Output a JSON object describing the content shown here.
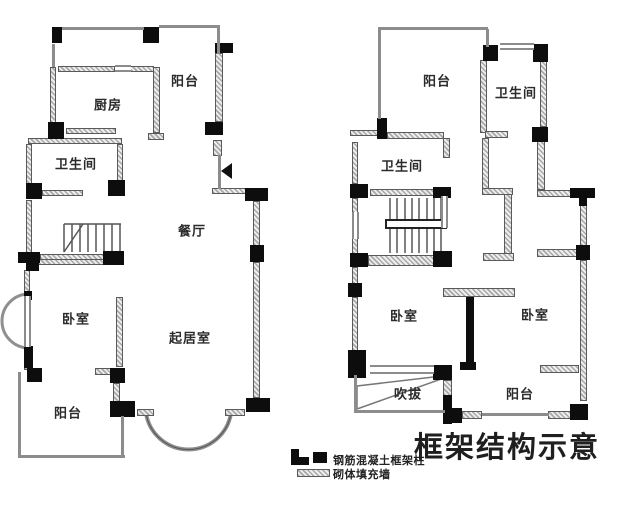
{
  "title": "框架结构示意",
  "legend": {
    "items": [
      {
        "symbol": "concrete-column",
        "label": "钢筋混凝土框架柱"
      },
      {
        "symbol": "masonry-infill-wall",
        "label": "砌体填充墙"
      }
    ]
  },
  "floor_left": {
    "rooms": {
      "balcony_top": "阳台",
      "kitchen": "厨房",
      "bathroom": "卫生间",
      "dining": "餐厅",
      "bedroom": "卧室",
      "living": "起居室",
      "balcony_bottom": "阳台"
    }
  },
  "floor_right": {
    "rooms": {
      "balcony_top": "阳台",
      "bathroom_top": "卫生间",
      "bathroom_mid": "卫生间",
      "bedroom_left": "卧室",
      "bedroom_right": "卧室",
      "void": "吹拔",
      "balcony_bottom": "阳台"
    }
  },
  "colors": {
    "background": "#ffffff",
    "wall_hatch": "#a8a8a8",
    "column": "#0d0d0d",
    "thin_line": "#8c8c8c",
    "text": "#2b2b2b"
  }
}
